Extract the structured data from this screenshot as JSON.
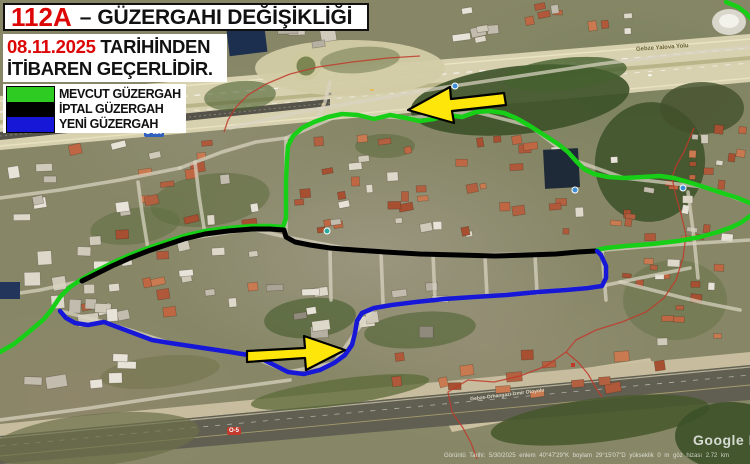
{
  "header": {
    "route_code": "112A",
    "separator": "–",
    "title": "GÜZERGAHI DEĞİŞİKLİĞİ",
    "date": "08.11.2025",
    "date_suffix": " TARİHİNDEN",
    "line2": "İTİBAREN GEÇERLİDİR."
  },
  "legend": {
    "items": [
      {
        "label": "MEVCUT GÜZERGAH",
        "color": "#2ecb22"
      },
      {
        "label": "İPTAL GÜZERGAH",
        "color": "#000000"
      },
      {
        "label": "YENİ GÜZERGAH",
        "color": "#1717d8"
      }
    ]
  },
  "routes": {
    "mevcut": {
      "label": "MEVCUT GÜZERGAH",
      "color": "#17cf17",
      "segments": [
        [
          [
            0,
            352
          ],
          [
            14,
            344
          ],
          [
            30,
            331
          ],
          [
            44,
            319
          ],
          [
            52,
            309
          ],
          [
            60,
            297
          ],
          [
            70,
            287
          ],
          [
            82,
            279
          ],
          [
            96,
            271
          ],
          [
            112,
            263
          ],
          [
            130,
            255
          ],
          [
            148,
            248
          ],
          [
            166,
            242
          ],
          [
            184,
            236
          ],
          [
            205,
            231
          ],
          [
            228,
            228
          ],
          [
            252,
            226
          ],
          [
            270,
            226
          ],
          [
            283,
            227
          ],
          [
            286,
            218
          ],
          [
            286,
            200
          ],
          [
            286,
            180
          ],
          [
            287,
            160
          ],
          [
            288,
            146
          ],
          [
            293,
            136
          ],
          [
            302,
            128
          ],
          [
            314,
            122
          ],
          [
            328,
            117
          ],
          [
            342,
            114
          ],
          [
            358,
            115
          ],
          [
            374,
            119
          ],
          [
            390,
            115
          ],
          [
            406,
            118
          ],
          [
            420,
            121
          ],
          [
            434,
            119
          ],
          [
            448,
            115
          ],
          [
            462,
            117
          ],
          [
            476,
            112
          ],
          [
            490,
            111
          ],
          [
            504,
            113
          ],
          [
            516,
            118
          ],
          [
            530,
            126
          ],
          [
            544,
            135
          ],
          [
            558,
            144
          ],
          [
            568,
            152
          ],
          [
            576,
            161
          ],
          [
            584,
            169
          ],
          [
            594,
            174
          ],
          [
            608,
            177
          ],
          [
            624,
            178
          ],
          [
            642,
            177
          ],
          [
            660,
            176
          ],
          [
            674,
            178
          ],
          [
            688,
            182
          ],
          [
            704,
            187
          ],
          [
            722,
            193
          ],
          [
            738,
            198
          ],
          [
            750,
            203
          ]
        ],
        [
          [
            750,
            216
          ],
          [
            742,
            222
          ],
          [
            732,
            227
          ],
          [
            718,
            232
          ],
          [
            700,
            237
          ],
          [
            678,
            241
          ],
          [
            652,
            244
          ],
          [
            626,
            246
          ],
          [
            606,
            248
          ],
          [
            597,
            250
          ]
        ],
        [
          [
            726,
            2
          ],
          [
            738,
            7
          ],
          [
            746,
            13
          ],
          [
            750,
            18
          ]
        ]
      ]
    },
    "iptal": {
      "label": "İPTAL GÜZERGAH",
      "color": "#000000",
      "segments": [
        [
          [
            82,
            281
          ],
          [
            96,
            274
          ],
          [
            112,
            266
          ],
          [
            130,
            258
          ],
          [
            148,
            251
          ],
          [
            166,
            245
          ],
          [
            184,
            239
          ],
          [
            205,
            234
          ],
          [
            228,
            231
          ],
          [
            252,
            229
          ],
          [
            270,
            229
          ],
          [
            284,
            230
          ],
          [
            286,
            237
          ],
          [
            295,
            242
          ],
          [
            310,
            245
          ],
          [
            330,
            248
          ],
          [
            355,
            250
          ],
          [
            385,
            252
          ],
          [
            420,
            254
          ],
          [
            458,
            255
          ],
          [
            495,
            256
          ],
          [
            528,
            255
          ],
          [
            556,
            254
          ],
          [
            578,
            252
          ],
          [
            595,
            251
          ]
        ]
      ]
    },
    "yeni": {
      "label": "YENİ GÜZERGAH",
      "color": "#1717d8",
      "segments": [
        [
          [
            60,
            311
          ],
          [
            66,
            318
          ],
          [
            75,
            323
          ],
          [
            88,
            325
          ],
          [
            104,
            322
          ],
          [
            120,
            328
          ],
          [
            136,
            334
          ],
          [
            152,
            340
          ],
          [
            170,
            343
          ],
          [
            190,
            346
          ],
          [
            210,
            349
          ],
          [
            230,
            352
          ],
          [
            248,
            355
          ],
          [
            262,
            359
          ],
          [
            274,
            365
          ],
          [
            288,
            372
          ],
          [
            304,
            374
          ],
          [
            320,
            370
          ],
          [
            334,
            363
          ],
          [
            345,
            355
          ],
          [
            352,
            345
          ],
          [
            355,
            333
          ],
          [
            357,
            321
          ],
          [
            362,
            313
          ],
          [
            374,
            308
          ],
          [
            392,
            305
          ],
          [
            416,
            302
          ],
          [
            444,
            299
          ],
          [
            474,
            297
          ],
          [
            506,
            295
          ],
          [
            538,
            292
          ],
          [
            566,
            290
          ],
          [
            588,
            288
          ],
          [
            602,
            286
          ],
          [
            606,
            278
          ],
          [
            606,
            266
          ],
          [
            601,
            255
          ],
          [
            597,
            251
          ]
        ]
      ]
    }
  },
  "arrows": [
    {
      "name": "direction-arrow-left",
      "fill": "#ffe60a",
      "points": [
        [
          408,
          110
        ],
        [
          454,
          123
        ],
        [
          452,
          111
        ],
        [
          506,
          105
        ],
        [
          504,
          93
        ],
        [
          451,
          99
        ],
        [
          450,
          87
        ]
      ]
    },
    {
      "name": "direction-arrow-right",
      "fill": "#ffe60a",
      "points": [
        [
          345,
          350
        ],
        [
          304,
          336
        ],
        [
          305,
          348
        ],
        [
          247,
          351
        ],
        [
          247,
          362
        ],
        [
          305,
          358
        ],
        [
          306,
          370
        ]
      ]
    }
  ],
  "map": {
    "watermark": "Google Earth",
    "status_bar": "Görüntü Tarihi: 5/30/2025      enlem  40°47'29\"K   boylam  29°15'07\"D   yükseklik  0 m   göz hizası  2.72 km",
    "badges": [
      {
        "text": "D-130",
        "x": 144,
        "y": 129,
        "bg": "#2f5fbf"
      },
      {
        "text": "O-5",
        "x": 227,
        "y": 427,
        "bg": "#c23a2e"
      }
    ],
    "road_labels": [
      {
        "text": "Gebze Yalova Yolu",
        "x": 636,
        "y": 45,
        "rot": -4,
        "size": 6,
        "color": "#6b6436"
      },
      {
        "text": "Gebze-Orhangazi-İzmir Otoyolu",
        "x": 470,
        "y": 392,
        "rot": -7,
        "size": 5,
        "color": "#ded9c8"
      }
    ]
  }
}
